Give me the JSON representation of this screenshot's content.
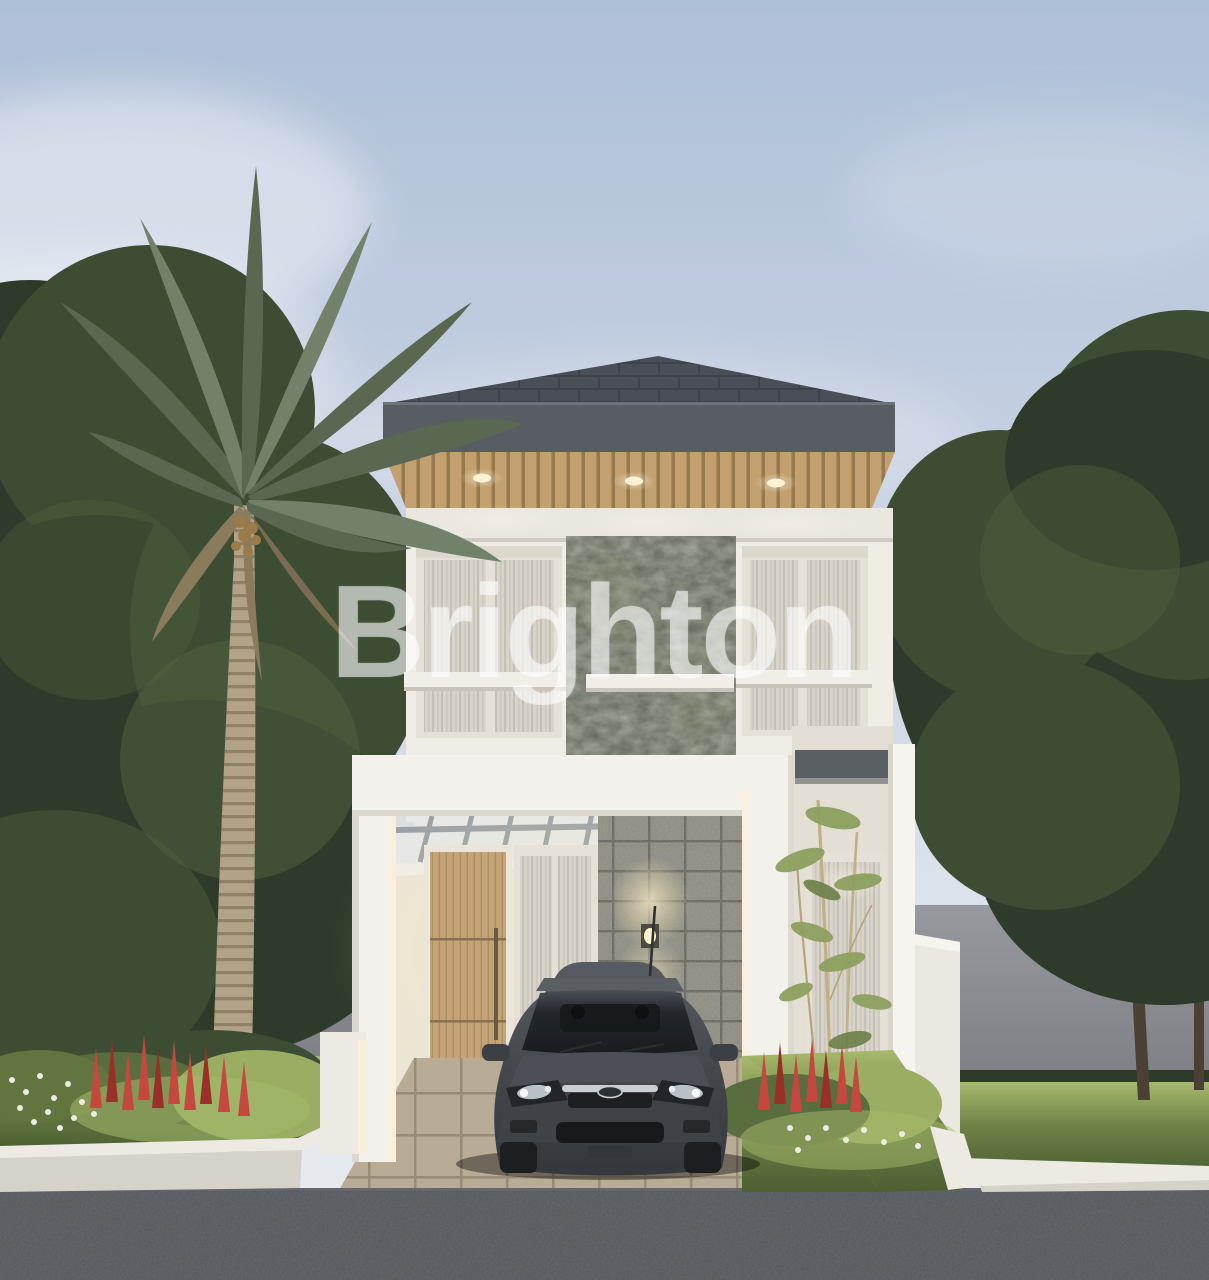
{
  "watermark": {
    "text": "Brighton"
  },
  "scene": {
    "description": "3D architectural rendering of a narrow two-storey modern white house at dusk, with hip roof, wood soffit with downlights, stone accent panel, carport portal frame with dark grey car parked, palm tree and gardens with red lupine flowers",
    "elements": [
      "sky",
      "clouds",
      "palm-tree",
      "left-trees",
      "right-tree",
      "boundary-walls",
      "hip-roof",
      "wood-soffit",
      "downlights",
      "second-floor-windows",
      "stone-accent-panel",
      "carport-portal",
      "pergola-canopy",
      "front-door",
      "wall-lamp",
      "stone-tile-wall",
      "bamboo-plant",
      "car",
      "flower-beds",
      "driveway",
      "road",
      "brand-watermark"
    ]
  },
  "lighting": {
    "soffit_downlight_count": 3,
    "wall_lamp_count": 1
  },
  "palette": {
    "sky-top": "#aebfd8",
    "sky-mid": "#c9d3e3",
    "sky-low": "#e2e7ee",
    "cloud": "#eef1f5",
    "foliage-dark": "#2e3b2a",
    "foliage-mid": "#3d4d34",
    "foliage-light": "#52643f",
    "grass-lit": "#a6b96b",
    "grass": "#6d8046",
    "grass-dark": "#4d6033",
    "bush-light": "#9aad62",
    "palm-frond": "#5a6852",
    "palm-frond-light": "#71816a",
    "palm-dry": "#8b7b5d",
    "palm-trunk": "#b2a287",
    "palm-trunk-dark": "#83755d",
    "wall-grey": "#8d9095",
    "wall-grey-dark": "#797b80",
    "boundary-white": "#eae8e1",
    "roof-tile": "#4a4f57",
    "roof-tile-dark": "#3d424a",
    "fascia": "#585d64",
    "soffit-wood": "#c2a06f",
    "soffit-wood-dark": "#97794e",
    "house-white": "#f0ede6",
    "house-shade": "#e3dfd5",
    "beam-white": "#eae7e0",
    "frame-white": "#f3f1ec",
    "curtain": "#d8d4cb",
    "curtain-dark": "#c5c0b4",
    "window-frame": "#e5e1d7",
    "stone-panel": "#5f6455",
    "stone-panel-light": "#7c806c",
    "stone-tile": "#8b8a80",
    "stone-grout": "#64645c",
    "door-wood": "#c5a478",
    "door-wood-dark": "#a0causes"
  }
}
